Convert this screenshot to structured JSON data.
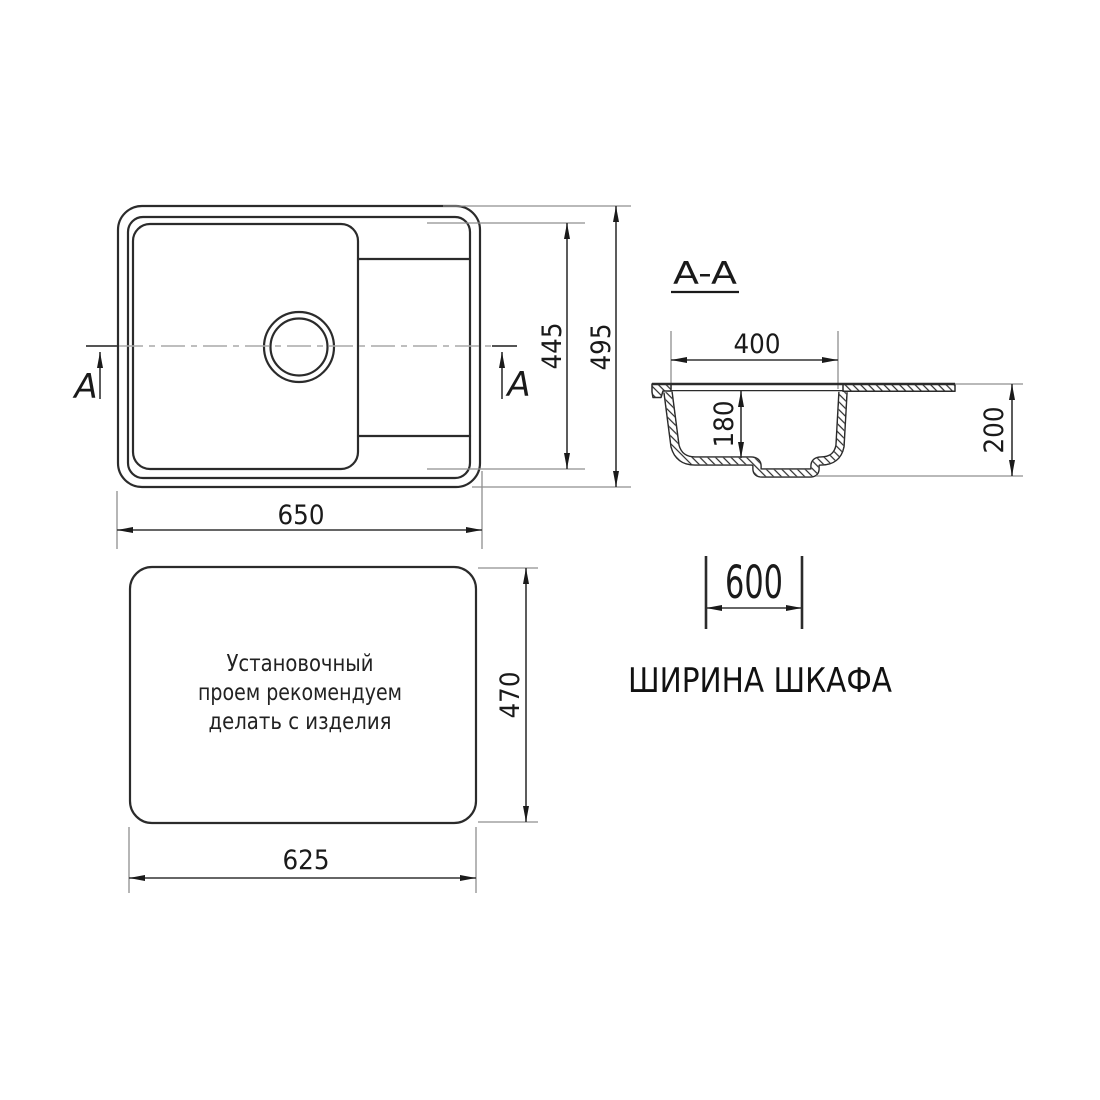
{
  "plan_view": {
    "overall_width": "650",
    "bowl_length": "445",
    "overall_depth": "495",
    "section_letter": "A"
  },
  "section_view": {
    "label": "A-A",
    "bowl_top_width": "400",
    "bowl_depth": "180",
    "overall_height": "200"
  },
  "cutout_view": {
    "note": [
      "Установочный",
      "проем рекомендуем",
      "делать с изделия"
    ],
    "cutout_width": "625",
    "cutout_depth": "470"
  },
  "cabinet": {
    "cabinet_width": "600",
    "caption": "ШИРИНА ШКАФА"
  },
  "colors": {
    "line": "#2b2b2b",
    "aux_line": "#8f8f8f",
    "text": "#1a1a1a",
    "background": "#ffffff"
  }
}
